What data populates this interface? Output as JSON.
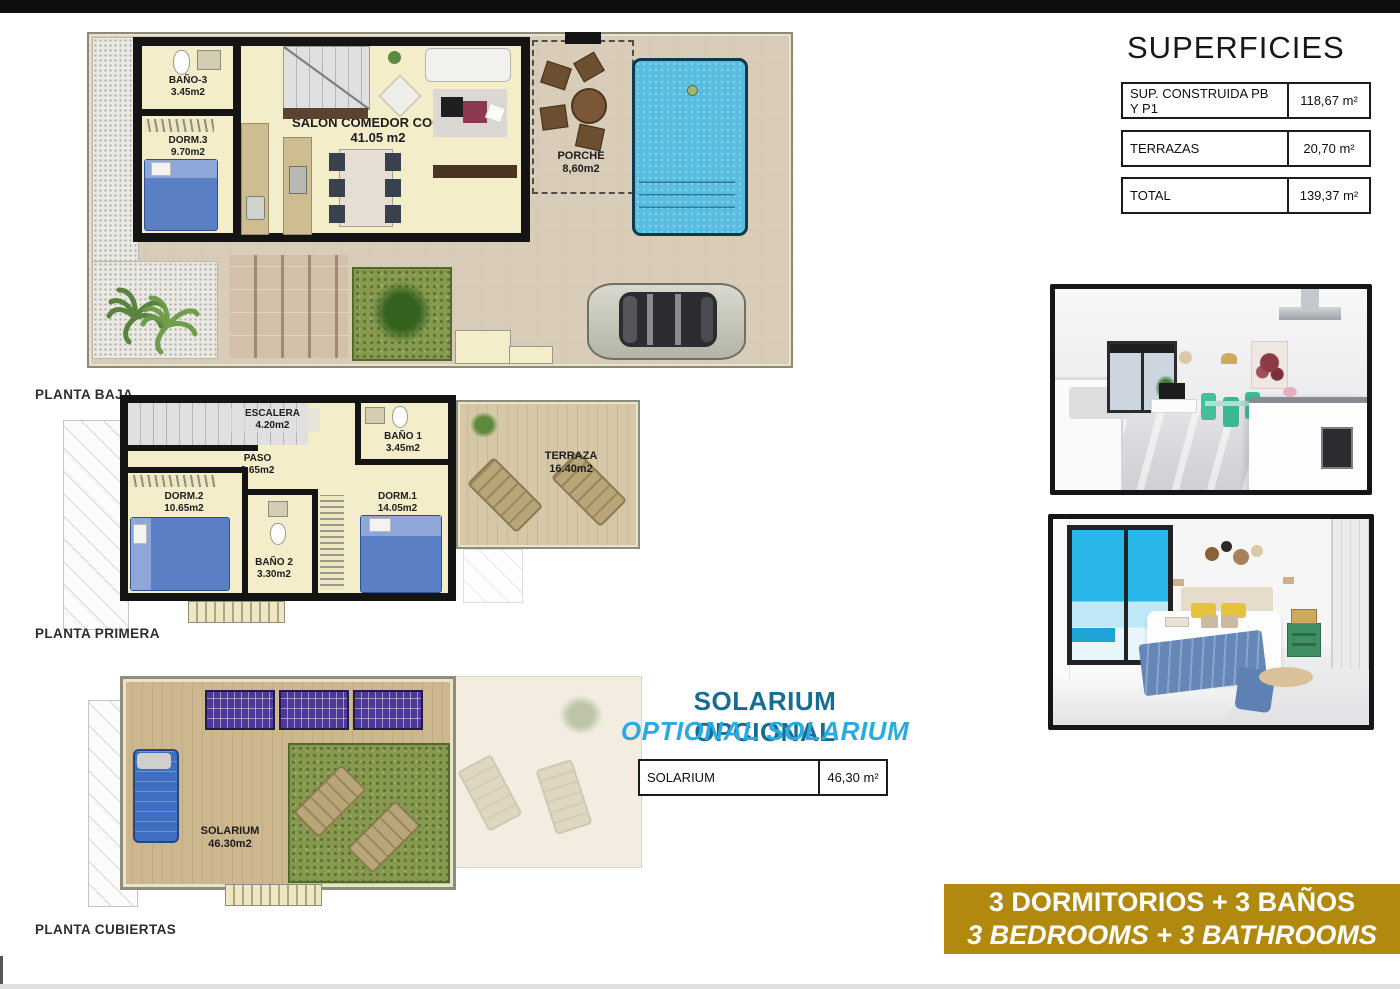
{
  "colors": {
    "banner_bg": "#b1890f",
    "solarium_title_es": "#186c94",
    "solarium_title_en": "#29abe2",
    "pool": "#57bedf"
  },
  "plans": {
    "baja": {
      "label": "PLANTA BAJA",
      "rooms": {
        "bano3": {
          "name": "BAÑO-3",
          "area": "3.45m2"
        },
        "dorm3": {
          "name": "DORM.3",
          "area": "9.70m2"
        },
        "salon": {
          "name": "SALON COMEDOR COCINA",
          "area": "41.05 m2"
        },
        "porche": {
          "name": "PORCHE",
          "area": "8,60m2"
        }
      }
    },
    "primera": {
      "label": "PLANTA PRIMERA",
      "rooms": {
        "escalera": {
          "name": "ESCALERA",
          "area": "4.20m2"
        },
        "paso": {
          "name": "PASO",
          "area": "2.65m2"
        },
        "bano1": {
          "name": "BAÑO 1",
          "area": "3.45m2"
        },
        "dorm2": {
          "name": "DORM.2",
          "area": "10.65m2"
        },
        "dorm1": {
          "name": "DORM.1",
          "area": "14.05m2"
        },
        "bano2": {
          "name": "BAÑO 2",
          "area": "3.30m2"
        },
        "terraza": {
          "name": "TERRAZA",
          "area": "16.40m2"
        }
      }
    },
    "cubiertas": {
      "label": "PLANTA CUBIERTAS",
      "rooms": {
        "solarium": {
          "name": "SOLARIUM",
          "area": "46.30m2"
        }
      }
    }
  },
  "superficies": {
    "title": "SUPERFICIES",
    "rows": [
      {
        "label": "SUP. CONSTRUIDA PB Y P1",
        "value": "118,67 m²"
      },
      {
        "label": "TERRAZAS",
        "value": "20,70 m²"
      },
      {
        "label": "TOTAL",
        "value": "139,37 m²"
      }
    ]
  },
  "solarium": {
    "title_es": "SOLARIUM OPCIONAL",
    "title_en": "OPTIONAL SOLARIUM",
    "row": {
      "label": "SOLARIUM",
      "value": "46,30 m²"
    }
  },
  "banner": {
    "line_es": "3 DORMITORIOS + 3 BAÑOS",
    "line_en": "3 BEDROOMS + 3 BATHROOMS"
  }
}
